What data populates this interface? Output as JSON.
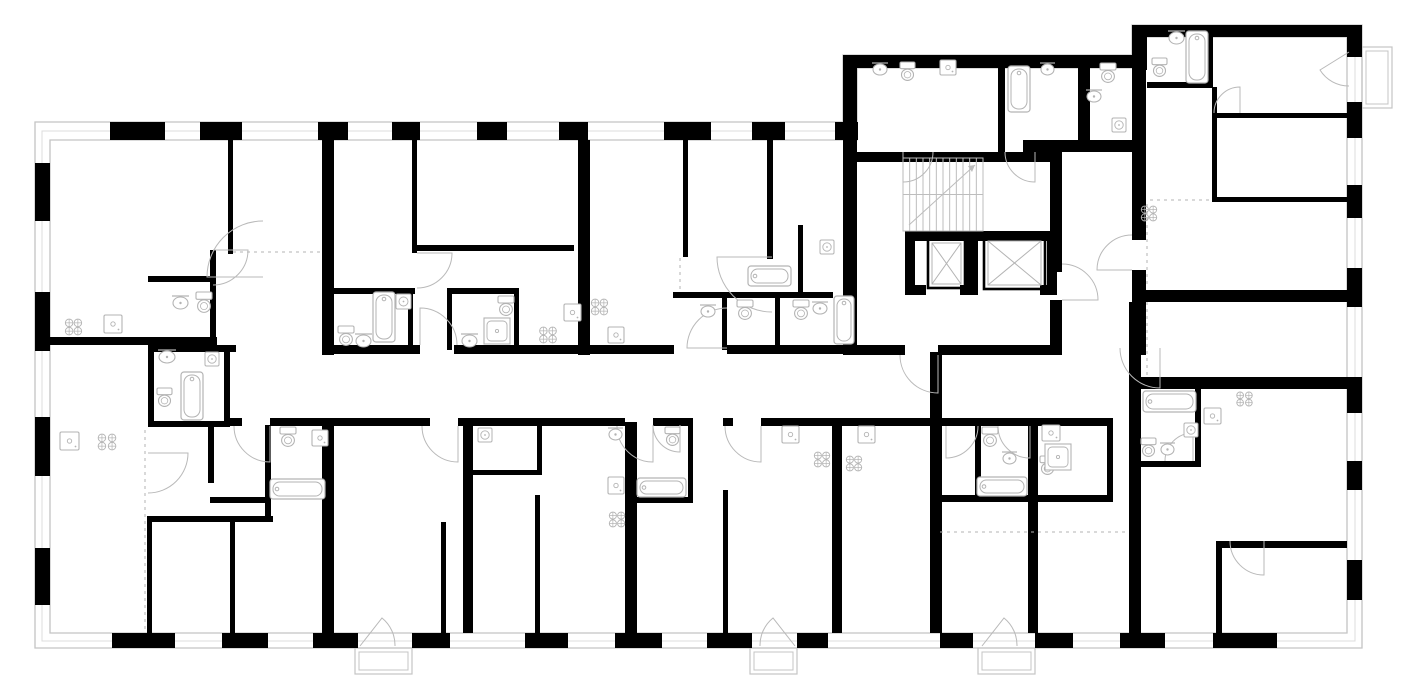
{
  "meta": {
    "type": "architectural-floor-plan",
    "description": "black-and-white apartment building floor plan with stair core, two elevators, apartments, bathrooms, kitchens and balconies"
  },
  "canvas": {
    "w": 1416,
    "h": 700
  },
  "colors": {
    "wall": "#000000",
    "fixture": "#b3b3b3",
    "door": "#b9b9b9",
    "outline": "#c4c4c4",
    "glass": "#dcdcdc",
    "stair": "#bdbdbd"
  },
  "envelope": {
    "outer": "M35,122 H843 V55 H1132 V25 H1362 V648 H35 Z",
    "mid": "M42,131 H850 V61 H1139 V31 H1355 V641 H42 Z",
    "inner": "M50,140 H857 V68 H1146 V37 H1347 V633 H50 Z"
  },
  "walls": [
    [
      110,
      122,
      55,
      18
    ],
    [
      200,
      122,
      42,
      18
    ],
    [
      318,
      122,
      30,
      18
    ],
    [
      392,
      122,
      28,
      18
    ],
    [
      477,
      122,
      30,
      18
    ],
    [
      559,
      122,
      29,
      18
    ],
    [
      664,
      122,
      47,
      18
    ],
    [
      752,
      122,
      33,
      18
    ],
    [
      835,
      122,
      23,
      18
    ],
    [
      843,
      55,
      292,
      13
    ],
    [
      1132,
      25,
      230,
      12
    ],
    [
      1132,
      25,
      15,
      45
    ],
    [
      843,
      55,
      14,
      85
    ],
    [
      35,
      163,
      15,
      58
    ],
    [
      35,
      292,
      15,
      59
    ],
    [
      35,
      417,
      15,
      59
    ],
    [
      35,
      548,
      15,
      57
    ],
    [
      112,
      633,
      63,
      15
    ],
    [
      222,
      633,
      46,
      15
    ],
    [
      313,
      633,
      45,
      15
    ],
    [
      412,
      633,
      38,
      15
    ],
    [
      525,
      633,
      43,
      15
    ],
    [
      615,
      633,
      47,
      15
    ],
    [
      707,
      633,
      45,
      15
    ],
    [
      797,
      633,
      31,
      15
    ],
    [
      940,
      633,
      33,
      15
    ],
    [
      1035,
      633,
      38,
      15
    ],
    [
      1120,
      633,
      45,
      15
    ],
    [
      1213,
      633,
      64,
      15
    ],
    [
      1347,
      25,
      15,
      32
    ],
    [
      1347,
      102,
      15,
      36
    ],
    [
      1347,
      185,
      15,
      33
    ],
    [
      1347,
      268,
      15,
      39
    ],
    [
      1347,
      377,
      15,
      36
    ],
    [
      1347,
      461,
      15,
      29
    ],
    [
      1347,
      560,
      15,
      40
    ],
    [
      322,
      140,
      12,
      215
    ],
    [
      578,
      140,
      12,
      215
    ],
    [
      228,
      140,
      5,
      114
    ],
    [
      412,
      140,
      5,
      113
    ],
    [
      683,
      140,
      5,
      117
    ],
    [
      767,
      140,
      6,
      119
    ],
    [
      412,
      245,
      162,
      6
    ],
    [
      210,
      250,
      6,
      92
    ],
    [
      148,
      276,
      64,
      6
    ],
    [
      45,
      337,
      172,
      8
    ],
    [
      148,
      345,
      88,
      7
    ],
    [
      148,
      345,
      6,
      82
    ],
    [
      224,
      345,
      6,
      82
    ],
    [
      148,
      421,
      82,
      6
    ],
    [
      334,
      345,
      86,
      9
    ],
    [
      454,
      345,
      220,
      9
    ],
    [
      727,
      345,
      116,
      9
    ],
    [
      330,
      288,
      85,
      6
    ],
    [
      408,
      288,
      5,
      62
    ],
    [
      447,
      288,
      72,
      6
    ],
    [
      447,
      288,
      5,
      62
    ],
    [
      514,
      288,
      5,
      62
    ],
    [
      673,
      292,
      160,
      6
    ],
    [
      722,
      296,
      5,
      54
    ],
    [
      775,
      296,
      5,
      54
    ],
    [
      798,
      225,
      5,
      67
    ],
    [
      843,
      122,
      14,
      233
    ],
    [
      855,
      152,
      195,
      10
    ],
    [
      1050,
      152,
      12,
      120
    ],
    [
      1050,
      300,
      12,
      55
    ],
    [
      905,
      231,
      152,
      10
    ],
    [
      905,
      231,
      10,
      64
    ],
    [
      966,
      231,
      12,
      64
    ],
    [
      1047,
      231,
      10,
      64
    ],
    [
      905,
      285,
      21,
      10
    ],
    [
      960,
      285,
      14,
      10
    ],
    [
      1040,
      285,
      17,
      10
    ],
    [
      857,
      345,
      48,
      10
    ],
    [
      938,
      345,
      119,
      10
    ],
    [
      998,
      67,
      7,
      85
    ],
    [
      1078,
      55,
      12,
      97
    ],
    [
      1023,
      140,
      109,
      12
    ],
    [
      1132,
      67,
      14,
      173
    ],
    [
      1132,
      270,
      14,
      85
    ],
    [
      1207,
      25,
      6,
      62
    ],
    [
      1147,
      82,
      66,
      6
    ],
    [
      1212,
      87,
      5,
      115
    ],
    [
      1213,
      197,
      134,
      5
    ],
    [
      1213,
      113,
      134,
      5
    ],
    [
      1132,
      290,
      230,
      12
    ],
    [
      1135,
      377,
      212,
      12
    ],
    [
      1195,
      389,
      6,
      78
    ],
    [
      1141,
      461,
      60,
      6
    ],
    [
      1221,
      541,
      126,
      7
    ],
    [
      1216,
      541,
      6,
      92
    ],
    [
      1129,
      302,
      12,
      331
    ],
    [
      230,
      418,
      12,
      8
    ],
    [
      270,
      418,
      64,
      8
    ],
    [
      334,
      418,
      96,
      8
    ],
    [
      458,
      418,
      147,
      8
    ],
    [
      605,
      418,
      20,
      8
    ],
    [
      653,
      418,
      40,
      8
    ],
    [
      723,
      418,
      10,
      8
    ],
    [
      761,
      418,
      79,
      8
    ],
    [
      840,
      418,
      90,
      8
    ],
    [
      322,
      426,
      12,
      207
    ],
    [
      463,
      426,
      10,
      207
    ],
    [
      625,
      422,
      12,
      211
    ],
    [
      832,
      418,
      10,
      215
    ],
    [
      930,
      352,
      12,
      281
    ],
    [
      1028,
      418,
      10,
      215
    ],
    [
      147,
      516,
      126,
      6
    ],
    [
      147,
      522,
      5,
      111
    ],
    [
      230,
      522,
      5,
      111
    ],
    [
      208,
      425,
      6,
      58
    ],
    [
      265,
      425,
      6,
      93
    ],
    [
      210,
      497,
      60,
      6
    ],
    [
      441,
      522,
      5,
      111
    ],
    [
      535,
      495,
      5,
      138
    ],
    [
      723,
      490,
      5,
      143
    ],
    [
      537,
      420,
      5,
      55
    ],
    [
      472,
      470,
      70,
      5
    ],
    [
      632,
      497,
      61,
      6
    ],
    [
      688,
      425,
      5,
      77
    ],
    [
      940,
      418,
      97,
      8
    ],
    [
      975,
      425,
      6,
      77
    ],
    [
      940,
      495,
      97,
      7
    ],
    [
      1037,
      418,
      76,
      8
    ],
    [
      1107,
      418,
      6,
      84
    ],
    [
      1037,
      495,
      76,
      7
    ]
  ],
  "dashed": [
    [
      145,
      430,
      145,
      631
    ],
    [
      940,
      532,
      1128,
      532
    ],
    [
      1147,
      204,
      1147,
      288
    ],
    [
      680,
      258,
      680,
      290
    ],
    [
      233,
      252,
      322,
      252
    ],
    [
      1147,
      302,
      1147,
      377
    ],
    [
      1150,
      200,
      1212,
      200
    ]
  ],
  "doors": [
    "M263,277 L207,277 A56 56 0 0 1 263,221",
    "M420,345 L420,308 A37 37 0 0 1 457,345",
    "M727,348 L687,348 A40 40 0 0 1 727,308",
    "M772,257 L717,257 A55 55 0 0 0 772,312",
    "M938,355 L938,393 A38 38 0 0 1 900,355",
    "M148,453 L188,453 A40 40 0 0 1 148,493",
    "M270,426 L270,462 A36 36 0 0 1 234,426",
    "M458,426 L458,462 A36 36 0 0 1 422,426",
    "M653,426 L653,462 A36 36 0 0 1 617,426",
    "M761,426 L761,462 A36 36 0 0 1 725,426",
    "M946,426 L946,458 A32 32 0 0 0 978,426",
    "M1030,426 L1030,458 A32 32 0 0 1 998,426",
    "M1160,348 L1160,388 A40 40 0 0 1 1120,348",
    "M1062,300 L1098,300 A36 36 0 0 0 1062,264",
    "M1132,270 L1097,270 A35 35 0 0 1 1132,235",
    "M1240,113 L1240,87 A26 26 0 0 0 1214,113",
    "M1264,541 L1264,575 A34 34 0 0 1 1230,541",
    "M1035,152 L1035,182 A30 30 0 0 1 1005,152",
    "M903,152 L903,182 A30 30 0 0 0 933,152",
    "M213,250 L248,250 A35 35 0 0 1 213,285",
    "M417,253 L452,253 A35 35 0 0 1 417,288",
    "M680,425 L680,452 A27 27 0 0 1 653,425",
    "M1193,461 L1193,433 A28 28 0 0 0 1165,461",
    "M360,646 L382,618 A35 35 0 0 1 395,646",
    "M795,646 L773,618 A35 35 0 0 0 760,646",
    "M982,646 L1004,618 A35 35 0 0 1 1017,646",
    "M1349,52 L1320,70 A34 34 0 0 0 1349,86"
  ],
  "stairs": {
    "x": 903,
    "y": 158,
    "w": 80,
    "h": 73,
    "steps": 12
  },
  "elevators": [
    [
      928,
      239,
      37,
      49
    ],
    [
      984,
      237,
      61,
      52
    ]
  ],
  "balconies": [
    [
      355,
      648,
      57,
      26
    ],
    [
      750,
      648,
      47,
      26
    ],
    [
      978,
      648,
      57,
      26
    ],
    [
      1362,
      47,
      30,
      61
    ]
  ],
  "fixtures": [
    [
      "tub",
      181,
      372,
      22,
      48
    ],
    [
      "tub",
      373,
      292,
      22,
      50
    ],
    [
      "tub",
      834,
      296,
      20,
      48
    ],
    [
      "tub",
      1008,
      66,
      22,
      46
    ],
    [
      "tub",
      1186,
      31,
      22,
      52
    ],
    [
      "tub",
      270,
      479,
      55,
      20
    ],
    [
      "tub",
      637,
      478,
      49,
      19
    ],
    [
      "tub",
      977,
      477,
      50,
      19
    ],
    [
      "tub",
      1143,
      391,
      53,
      21
    ],
    [
      "tub",
      748,
      266,
      43,
      20
    ],
    [
      "toilet",
      196,
      292,
      16,
      21
    ],
    [
      "toilet",
      338,
      326,
      16,
      20
    ],
    [
      "toilet",
      498,
      296,
      16,
      20
    ],
    [
      "toilet",
      737,
      300,
      16,
      20
    ],
    [
      "toilet",
      793,
      300,
      16,
      20
    ],
    [
      "toilet",
      1100,
      63,
      16,
      20
    ],
    [
      "toilet",
      1152,
      58,
      15,
      19
    ],
    [
      "toilet",
      665,
      427,
      15,
      19
    ],
    [
      "toilet",
      280,
      427,
      16,
      20
    ],
    [
      "toilet",
      982,
      427,
      16,
      20
    ],
    [
      "toilet",
      1040,
      456,
      15,
      19
    ],
    [
      "toilet",
      1141,
      438,
      15,
      19
    ],
    [
      "toilet",
      157,
      388,
      15,
      19
    ],
    [
      "toilet",
      900,
      62,
      15,
      19
    ],
    [
      "basin",
      158,
      350,
      18,
      12
    ],
    [
      "basin",
      355,
      334,
      17,
      12
    ],
    [
      "basin",
      461,
      334,
      17,
      12
    ],
    [
      "basin",
      700,
      305,
      16,
      11
    ],
    [
      "basin",
      812,
      302,
      16,
      11
    ],
    [
      "basin",
      1086,
      90,
      16,
      11
    ],
    [
      "basin",
      1168,
      31,
      17,
      12
    ],
    [
      "basin",
      1040,
      63,
      15,
      11
    ],
    [
      "basin",
      872,
      63,
      16,
      11
    ],
    [
      "basin",
      1002,
      452,
      15,
      11
    ],
    [
      "basin",
      608,
      428,
      15,
      11
    ],
    [
      "basin",
      1160,
      443,
      15,
      11
    ],
    [
      "basin",
      172,
      296,
      17,
      12
    ],
    [
      "sink",
      104,
      315,
      18,
      18
    ],
    [
      "sink",
      60,
      432,
      19,
      18
    ],
    [
      "sink",
      312,
      430,
      16,
      16
    ],
    [
      "sink",
      564,
      304,
      17,
      17
    ],
    [
      "sink",
      608,
      327,
      16,
      16
    ],
    [
      "sink",
      608,
      477,
      16,
      17
    ],
    [
      "sink",
      782,
      426,
      17,
      17
    ],
    [
      "sink",
      858,
      426,
      17,
      17
    ],
    [
      "sink",
      940,
      60,
      16,
      15
    ],
    [
      "sink",
      1042,
      425,
      18,
      16
    ],
    [
      "sink",
      1204,
      408,
      17,
      16
    ],
    [
      "stove",
      64,
      318,
      19,
      18
    ],
    [
      "stove",
      96,
      433,
      22,
      18
    ],
    [
      "stove",
      538,
      326,
      20,
      18
    ],
    [
      "stove",
      590,
      298,
      19,
      18
    ],
    [
      "stove",
      608,
      511,
      18,
      17
    ],
    [
      "stove",
      813,
      451,
      18,
      17
    ],
    [
      "stove",
      845,
      455,
      18,
      17
    ],
    [
      "stove",
      1140,
      205,
      18,
      17
    ],
    [
      "stove",
      1235,
      391,
      19,
      16
    ],
    [
      "sh",
      205,
      352,
      14,
      14
    ],
    [
      "sh",
      396,
      294,
      15,
      15
    ],
    [
      "sh",
      478,
      428,
      14,
      14
    ],
    [
      "sh",
      1112,
      118,
      14,
      14
    ],
    [
      "sh",
      1184,
      423,
      14,
      14
    ],
    [
      "sh",
      820,
      240,
      14,
      14
    ],
    [
      "tray",
      484,
      318,
      26,
      26
    ],
    [
      "tray",
      1045,
      444,
      26,
      26
    ]
  ]
}
